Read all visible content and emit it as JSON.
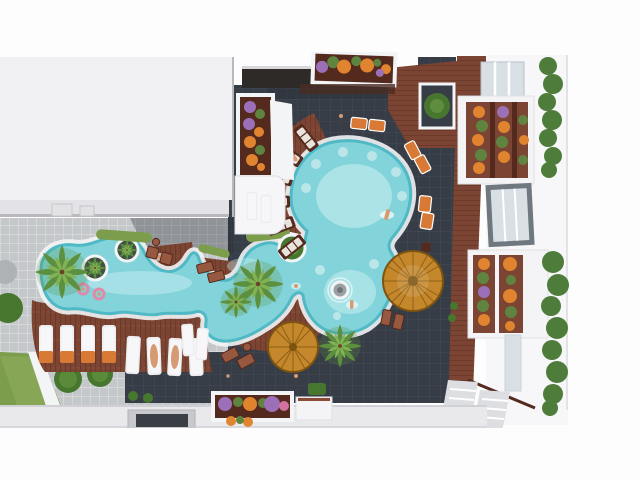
{
  "scene": {
    "type": "3d-architectural-aerial-render",
    "subject": "Resort courtyard with freeform lazy-river swimming pool between white apartment buildings",
    "view": "top-down aerial, bright daylight",
    "no_visible_text": true
  },
  "palette": {
    "white": "#FDFDFE",
    "roof": "#F0EFF2",
    "roof_band": "#E3E2E6",
    "plaza": "#C5C8CA",
    "plaza_line": "#DFE0E2",
    "court": "#373D46",
    "court_line": "#454C57",
    "wood": "#7C4533",
    "wood_dark": "#54291E",
    "wood_light": "#96583F",
    "coping": "#F2F4F5",
    "water": "#82D3DA",
    "water_deep": "#4FB9C5",
    "water_light": "#C6EEF0",
    "grass": "#7C9E4C",
    "grass_light": "#95B163",
    "bush": "#47762F",
    "palm": "#5C8F3E",
    "palm_light": "#83B254",
    "thatch": "#C4872B",
    "thatch_dark": "#7D5310",
    "flower_orange": "#E08430",
    "flower_purple": "#9C70B9",
    "flower_pink": "#D3719F",
    "flower_green": "#5E8440",
    "lounger_white": "#EDEDEF",
    "towel_orange": "#D87A35",
    "skin": "#D69B73",
    "hedge": "#4E7C3A",
    "band": "#E9E9EC",
    "glass": "#D8E0E5",
    "frame_gray": "#70787F",
    "shadow": "#23272E"
  },
  "buildings": {
    "left_roof": "large flat white roof occupying upper-left quarter, thin edge band with two vents at bottom",
    "left_balconies": "dark window band, flower planter (purple/orange) and white terrace with two white loungers on the roof's right edge",
    "top_planter": "white framed flower box with purple, green and orange plants at top centre",
    "right_tower": "white building along right side with glass skylights, two flower balconies, grey-framed window, two vertical hedges and steps at bottom",
    "foreground_roof": "white parapet band across the bottom with one flower planter and one grey planter"
  },
  "pool": {
    "shape": "freeform lazy-river: large round lobe, lower lobe, long wavy west arm and lagoon",
    "islands": 3,
    "island_kinds": [
      "planter island with mini palm",
      "planter island with mini palm",
      "rock fountain island"
    ],
    "swimmers": 6,
    "pink_float_rings": 2,
    "in_pool_stools": 10
  },
  "furniture": {
    "white_loungers_with_orange_towels": 4,
    "white_loungers_row2": 4,
    "white_loungers_on_terraces": 4,
    "radial_wood_loungers_around_lobe": 6,
    "orange_poolside_loungers": 6,
    "brown_deck_seats": 8,
    "thatch_umbrellas": 2,
    "people_on_deck": 4
  },
  "vegetation": {
    "large_palms": 4,
    "small_palms_on_islands": 2,
    "round_bushes": 6,
    "grass_strips": 3,
    "hedge_columns": 2,
    "flower_planters": 6
  }
}
